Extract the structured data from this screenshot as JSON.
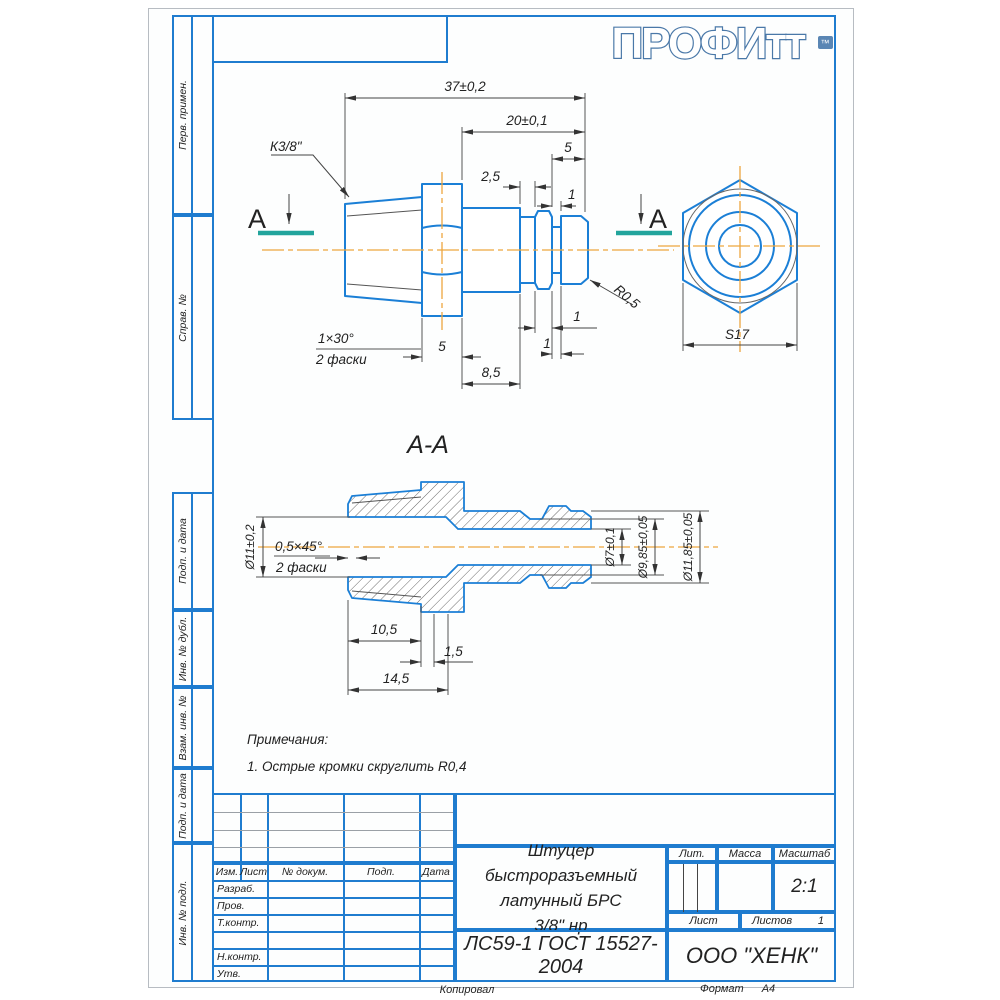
{
  "logo": {
    "text": "ПРОФИтт",
    "tm": "™"
  },
  "sidebar": [
    "Перв. примен.",
    "Справ. №",
    "Подп. и дата",
    "Инв. № дубл.",
    "Взам. инв. №",
    "Подп. и дата",
    "Инв. № подл."
  ],
  "drawing": {
    "section_title": "А-А",
    "cut_label_left": "А",
    "cut_label_right": "А",
    "notes_title": "Примечания:",
    "note1": "1. Острые кромки скруглить R0,4",
    "dims_main": {
      "total_length": "37±0,2",
      "body_length": "20±0,1",
      "neck_end_len": "5",
      "step_len": "2,5",
      "collar_small": "1",
      "thread": "К3/8\"",
      "chamfer": "1×30°",
      "chamfer_note": "2 фаски",
      "hex_len": "5",
      "cyl_len": "8,5",
      "collar_len": "1",
      "groove_len": "1",
      "fillet": "R0,5",
      "across_flats": "S17"
    },
    "dims_section": {
      "bore_dia": "Ø11±0,2",
      "chamfer": "0,5×45°",
      "chamfer_note": "2 фаски",
      "small_bore_dia": "Ø7±0,1",
      "groove_dia": "Ø9,85±0,05",
      "outer_dia": "Ø11,85±0,05",
      "thread_len": "10,5",
      "undercut_len": "1,5",
      "total_len": "14,5"
    }
  },
  "titleblock": {
    "header": [
      "Изм.",
      "Лист",
      "№ докум.",
      "Подп.",
      "Дата"
    ],
    "rows": [
      "Разраб.",
      "Пров.",
      "Т.контр.",
      "",
      "Н.контр.",
      "Утв."
    ],
    "title1": "Штуцер быстроразъемный",
    "title2": "латунный БРС",
    "title3": "3/8\" нр",
    "material": "ЛС59-1 ГОСТ 15527-2004",
    "company": "ООО \"ХЕНК\"",
    "lit_label": "Лит.",
    "mass_label": "Масса",
    "scale_label": "Масштаб",
    "scale_value": "2:1",
    "sheet_label": "Лист",
    "sheets_label": "Листов",
    "sheets_value": "1",
    "copied_label": "Копировал",
    "format_label": "Формат",
    "format_value": "А4"
  }
}
